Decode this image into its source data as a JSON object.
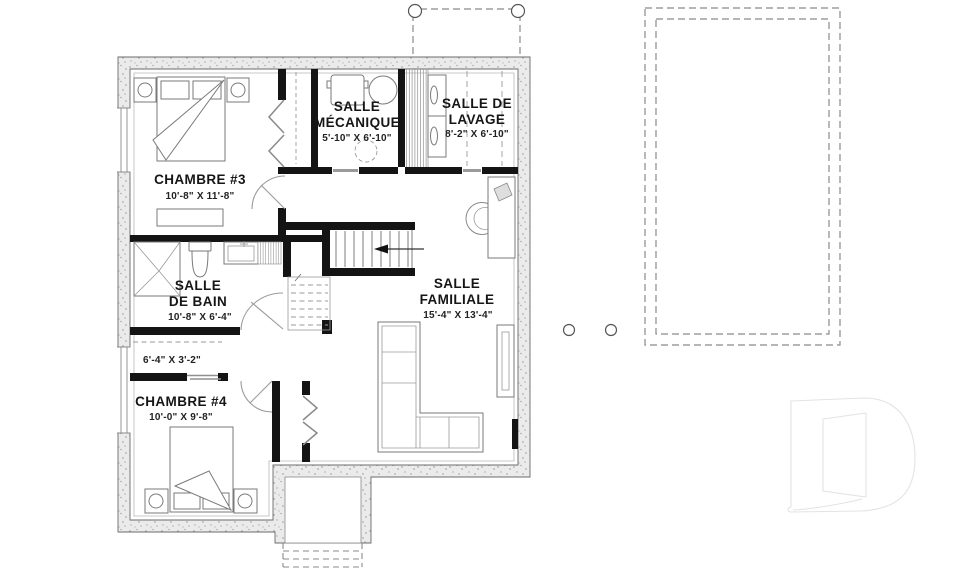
{
  "rooms": [
    {
      "id": "chambre-3",
      "line1": "CHAMBRE #3",
      "dims": "10'-8\" X 11'-8\""
    },
    {
      "id": "salle-mecanique",
      "line1": "SALLE",
      "line2": "MÉCANIQUE",
      "dims": "5'-10\" X 6'-10\""
    },
    {
      "id": "salle-de-lavage",
      "line1": "SALLE DE",
      "line2": "LAVAGE",
      "dims": "8'-2\" X 6'-10\""
    },
    {
      "id": "salle-de-bain",
      "line1": "SALLE",
      "line2": "DE BAIN",
      "dims": "10'-8\" X 6'-4\""
    },
    {
      "id": "rangement",
      "dims": "6'-4\" X 3'-2\""
    },
    {
      "id": "chambre-4",
      "line1": "CHAMBRE #4",
      "dims": "10'-0\" X 9'-8\""
    },
    {
      "id": "salle-familiale",
      "line1": "SALLE",
      "line2": "FAMILIALE",
      "dims": "15'-4\" X 13'-4\""
    }
  ],
  "colors": {
    "foundation_fill": "#ebebeb",
    "foundation_stipple": "#8d8d8d",
    "foundation_edge": "#6b6b6b",
    "partition": "#141414",
    "thin_line": "#7a7a7a",
    "dashed_line": "#8a8a8a",
    "label_text": "#161616",
    "logo_outline": "#e3e3e3",
    "background": "#ffffff"
  }
}
